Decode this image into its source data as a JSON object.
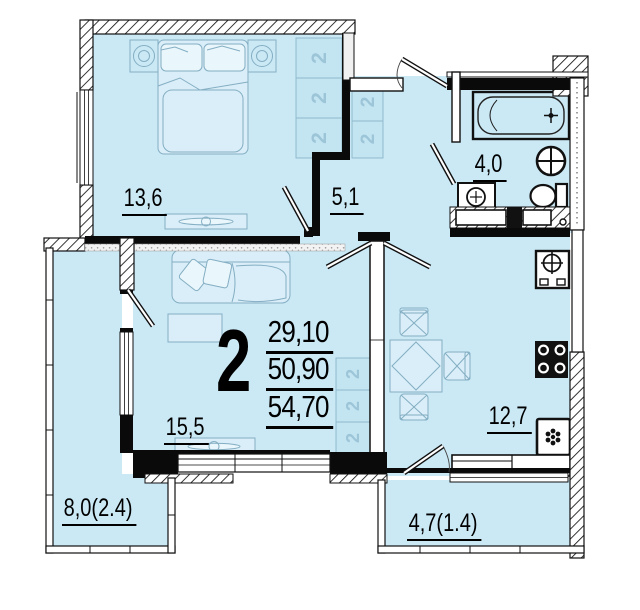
{
  "plan": {
    "type": "apartment-floor-plan",
    "rooms_badge": "2",
    "area_summary": {
      "living": "29,10",
      "heated": "50,90",
      "total": "54,70"
    },
    "rooms": {
      "bedroom": {
        "area": "13,6"
      },
      "hall": {
        "area": "5,1"
      },
      "bathroom": {
        "area": "4,0"
      },
      "living_room": {
        "area": "15,5"
      },
      "kitchen": {
        "area": "12,7"
      },
      "balcony_left": {
        "area": "8,0(2.4)"
      },
      "balcony_bottom": {
        "area": "4,7(1.4)"
      }
    },
    "wardrobe_glyph": "2",
    "colors": {
      "room_fill": "#cbe9f5",
      "furniture_line": "#84aec3",
      "furniture_fill": "#d9eef8",
      "wall": "#0a0a0a"
    },
    "icons": [
      "bed-icon",
      "nightstand-lamp-icon",
      "dresser-tv-icon",
      "wardrobe-hanger-icon",
      "sofa-icon",
      "coffee-table-icon",
      "tv-cabinet-icon",
      "dining-table-icon",
      "chair-icon",
      "kitchen-sink-icon",
      "stove-icon",
      "fridge-icon",
      "bathtub-icon",
      "washbasin-icon",
      "toilet-icon",
      "washing-machine-icon",
      "vent-shaft-icon",
      "door-leaf-icon",
      "window-icon"
    ]
  }
}
